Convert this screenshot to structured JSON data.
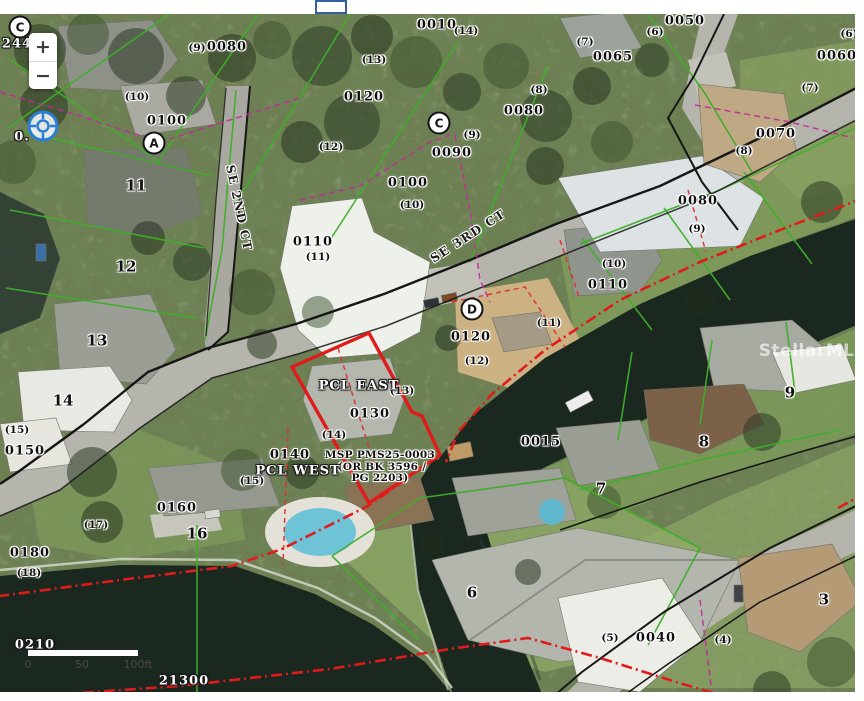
{
  "controls": {
    "zoom_in": "+",
    "zoom_out": "−"
  },
  "watermark": "StellarMLS",
  "scale_bar": {
    "ticks": [
      {
        "t": "0",
        "x": 28
      },
      {
        "t": "50",
        "x": 82
      },
      {
        "t": "100ft",
        "x": 138
      }
    ]
  },
  "colors": {
    "parcel_green": "#3fae2a",
    "highlight_red": "#e01b1b",
    "road_black": "#161616",
    "survey_magenta": "#c2299a",
    "dashed_red": "#e03030",
    "water": "#1b2820",
    "road_fill": "#b5b5ad",
    "canopy_base": "#6d7f52"
  },
  "markers": [
    {
      "t": "C",
      "x": 20,
      "y": 27
    },
    {
      "t": "A",
      "x": 154,
      "y": 143
    },
    {
      "t": "C",
      "x": 439,
      "y": 123
    },
    {
      "t": "D",
      "x": 472,
      "y": 309
    }
  ],
  "labels": {
    "streets": [
      {
        "t": "SE 2ND CT",
        "x": 239,
        "y": 208,
        "r": 78
      },
      {
        "t": "SE 3RD CT",
        "x": 468,
        "y": 236,
        "r": -33
      }
    ],
    "parcels": [
      {
        "t": "0010",
        "x": 437,
        "y": 25
      },
      {
        "t": "0080",
        "x": 227,
        "y": 47
      },
      {
        "t": "0120",
        "x": 364,
        "y": 97
      },
      {
        "t": "0100",
        "x": 167,
        "y": 121
      },
      {
        "t": "0065",
        "x": 613,
        "y": 57
      },
      {
        "t": "0050",
        "x": 685,
        "y": 21
      },
      {
        "t": "0060",
        "x": 837,
        "y": 56
      },
      {
        "t": "0070",
        "x": 776,
        "y": 134
      },
      {
        "t": "0080",
        "x": 524,
        "y": 111
      },
      {
        "t": "0090",
        "x": 452,
        "y": 153
      },
      {
        "t": "0100",
        "x": 408,
        "y": 183
      },
      {
        "t": "0110",
        "x": 313,
        "y": 242
      },
      {
        "t": "0110",
        "x": 608,
        "y": 285
      },
      {
        "t": "0080",
        "x": 698,
        "y": 201
      },
      {
        "t": "0120",
        "x": 471,
        "y": 337
      },
      {
        "t": "0130",
        "x": 370,
        "y": 414
      },
      {
        "t": "0140",
        "x": 290,
        "y": 455
      },
      {
        "t": "0150",
        "x": 25,
        "y": 451
      },
      {
        "t": "0160",
        "x": 177,
        "y": 508
      },
      {
        "t": "0180",
        "x": 30,
        "y": 553
      },
      {
        "t": "0015",
        "x": 541,
        "y": 442
      },
      {
        "t": "0040",
        "x": 656,
        "y": 638
      }
    ],
    "sublots": [
      {
        "t": "(9)",
        "x": 197,
        "y": 48
      },
      {
        "t": "(13)",
        "x": 374,
        "y": 60
      },
      {
        "t": "(12)",
        "x": 331,
        "y": 147
      },
      {
        "t": "(10)",
        "x": 137,
        "y": 97
      },
      {
        "t": "(14)",
        "x": 466,
        "y": 31
      },
      {
        "t": "(7)",
        "x": 585,
        "y": 42
      },
      {
        "t": "(8)",
        "x": 539,
        "y": 90
      },
      {
        "t": "(9)",
        "x": 472,
        "y": 135
      },
      {
        "t": "(6)",
        "x": 655,
        "y": 32
      },
      {
        "t": "(6)",
        "x": 849,
        "y": 34
      },
      {
        "t": "(7)",
        "x": 810,
        "y": 88
      },
      {
        "t": "(8)",
        "x": 744,
        "y": 151
      },
      {
        "t": "(10)",
        "x": 412,
        "y": 205
      },
      {
        "t": "(11)",
        "x": 318,
        "y": 257
      },
      {
        "t": "(10)",
        "x": 614,
        "y": 264
      },
      {
        "t": "(11)",
        "x": 549,
        "y": 323
      },
      {
        "t": "(12)",
        "x": 477,
        "y": 361
      },
      {
        "t": "(9)",
        "x": 697,
        "y": 229
      },
      {
        "t": "(13)",
        "x": 402,
        "y": 391
      },
      {
        "t": "(14)",
        "x": 334,
        "y": 435
      },
      {
        "t": "(15)",
        "x": 252,
        "y": 481
      },
      {
        "t": "(15)",
        "x": 17,
        "y": 430
      },
      {
        "t": "(17)",
        "x": 96,
        "y": 525
      },
      {
        "t": "(18)",
        "x": 29,
        "y": 573
      },
      {
        "t": "(5)",
        "x": 610,
        "y": 638
      },
      {
        "t": "(4)",
        "x": 723,
        "y": 640
      }
    ],
    "lots": [
      {
        "t": "11",
        "x": 136,
        "y": 186
      },
      {
        "t": "12",
        "x": 126,
        "y": 267
      },
      {
        "t": "13",
        "x": 97,
        "y": 341
      },
      {
        "t": "14",
        "x": 63,
        "y": 401
      },
      {
        "t": "16",
        "x": 197,
        "y": 534
      },
      {
        "t": "6",
        "x": 472,
        "y": 593
      },
      {
        "t": "7",
        "x": 601,
        "y": 489
      },
      {
        "t": "8",
        "x": 704,
        "y": 442
      },
      {
        "t": "9",
        "x": 790,
        "y": 393
      },
      {
        "t": "3",
        "x": 824,
        "y": 600
      }
    ],
    "deed_note": [
      {
        "t": "MSP PMS25-0003",
        "x": 380,
        "y": 455
      },
      {
        "t": "(OR BK 3596 /",
        "x": 382,
        "y": 467
      },
      {
        "t": "PG 2203)",
        "x": 380,
        "y": 478
      }
    ],
    "highlights": [
      {
        "t": "PCL EAST",
        "x": 359,
        "y": 386
      },
      {
        "t": "PCL WEST",
        "x": 298,
        "y": 471
      },
      {
        "t": "0210",
        "x": 35,
        "y": 645
      },
      {
        "t": "21300",
        "x": 184,
        "y": 681
      },
      {
        "t": "244",
        "x": 17,
        "y": 44
      },
      {
        "t": "0.",
        "x": 22,
        "y": 137
      }
    ]
  }
}
